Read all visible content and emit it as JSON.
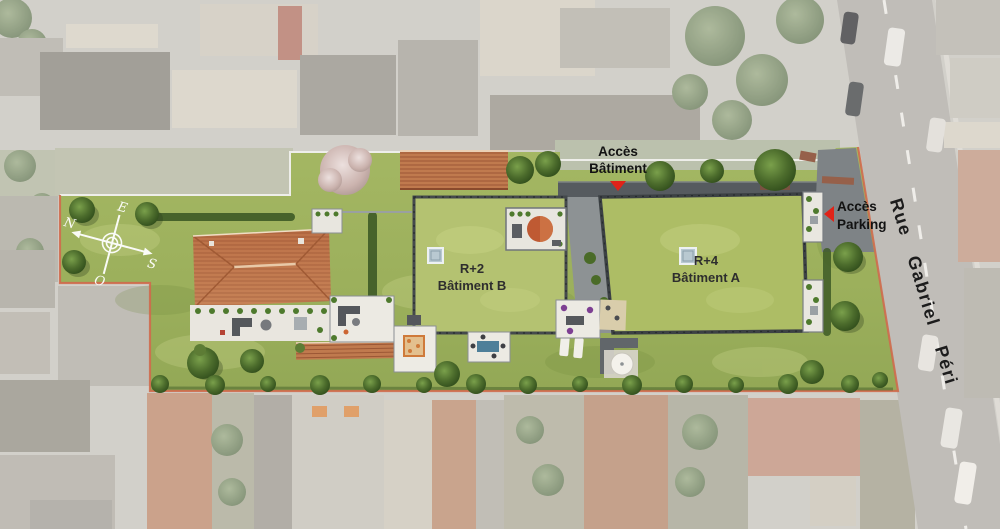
{
  "plan": {
    "access_building_label": {
      "line1": "Accès",
      "line2": "Bâtiment"
    },
    "access_parking_label": {
      "line1": "Accès",
      "line2": "Parking"
    },
    "building_b": {
      "level": "R+2",
      "name": "Bâtiment B"
    },
    "building_a": {
      "level": "R+4",
      "name": "Bâtiment A"
    },
    "street_name": "Rue Gabriel Péri",
    "compass": {
      "north": "N",
      "east": "E",
      "south": "S",
      "west": "O"
    }
  },
  "colors": {
    "lawn": "#9fb35f",
    "green_roof_b": "#b4c271",
    "green_roof_a": "#adbd65",
    "terracotta_roof": "#c0794e",
    "driveway_dark": "#565b5f",
    "access_gray": "#7e8386",
    "road": "#b2afa9",
    "site_boundary": "#cf6a4c",
    "arrow_red": "#e02318",
    "building_outline": "#44494c",
    "tree_dark": "#3c5a22"
  }
}
